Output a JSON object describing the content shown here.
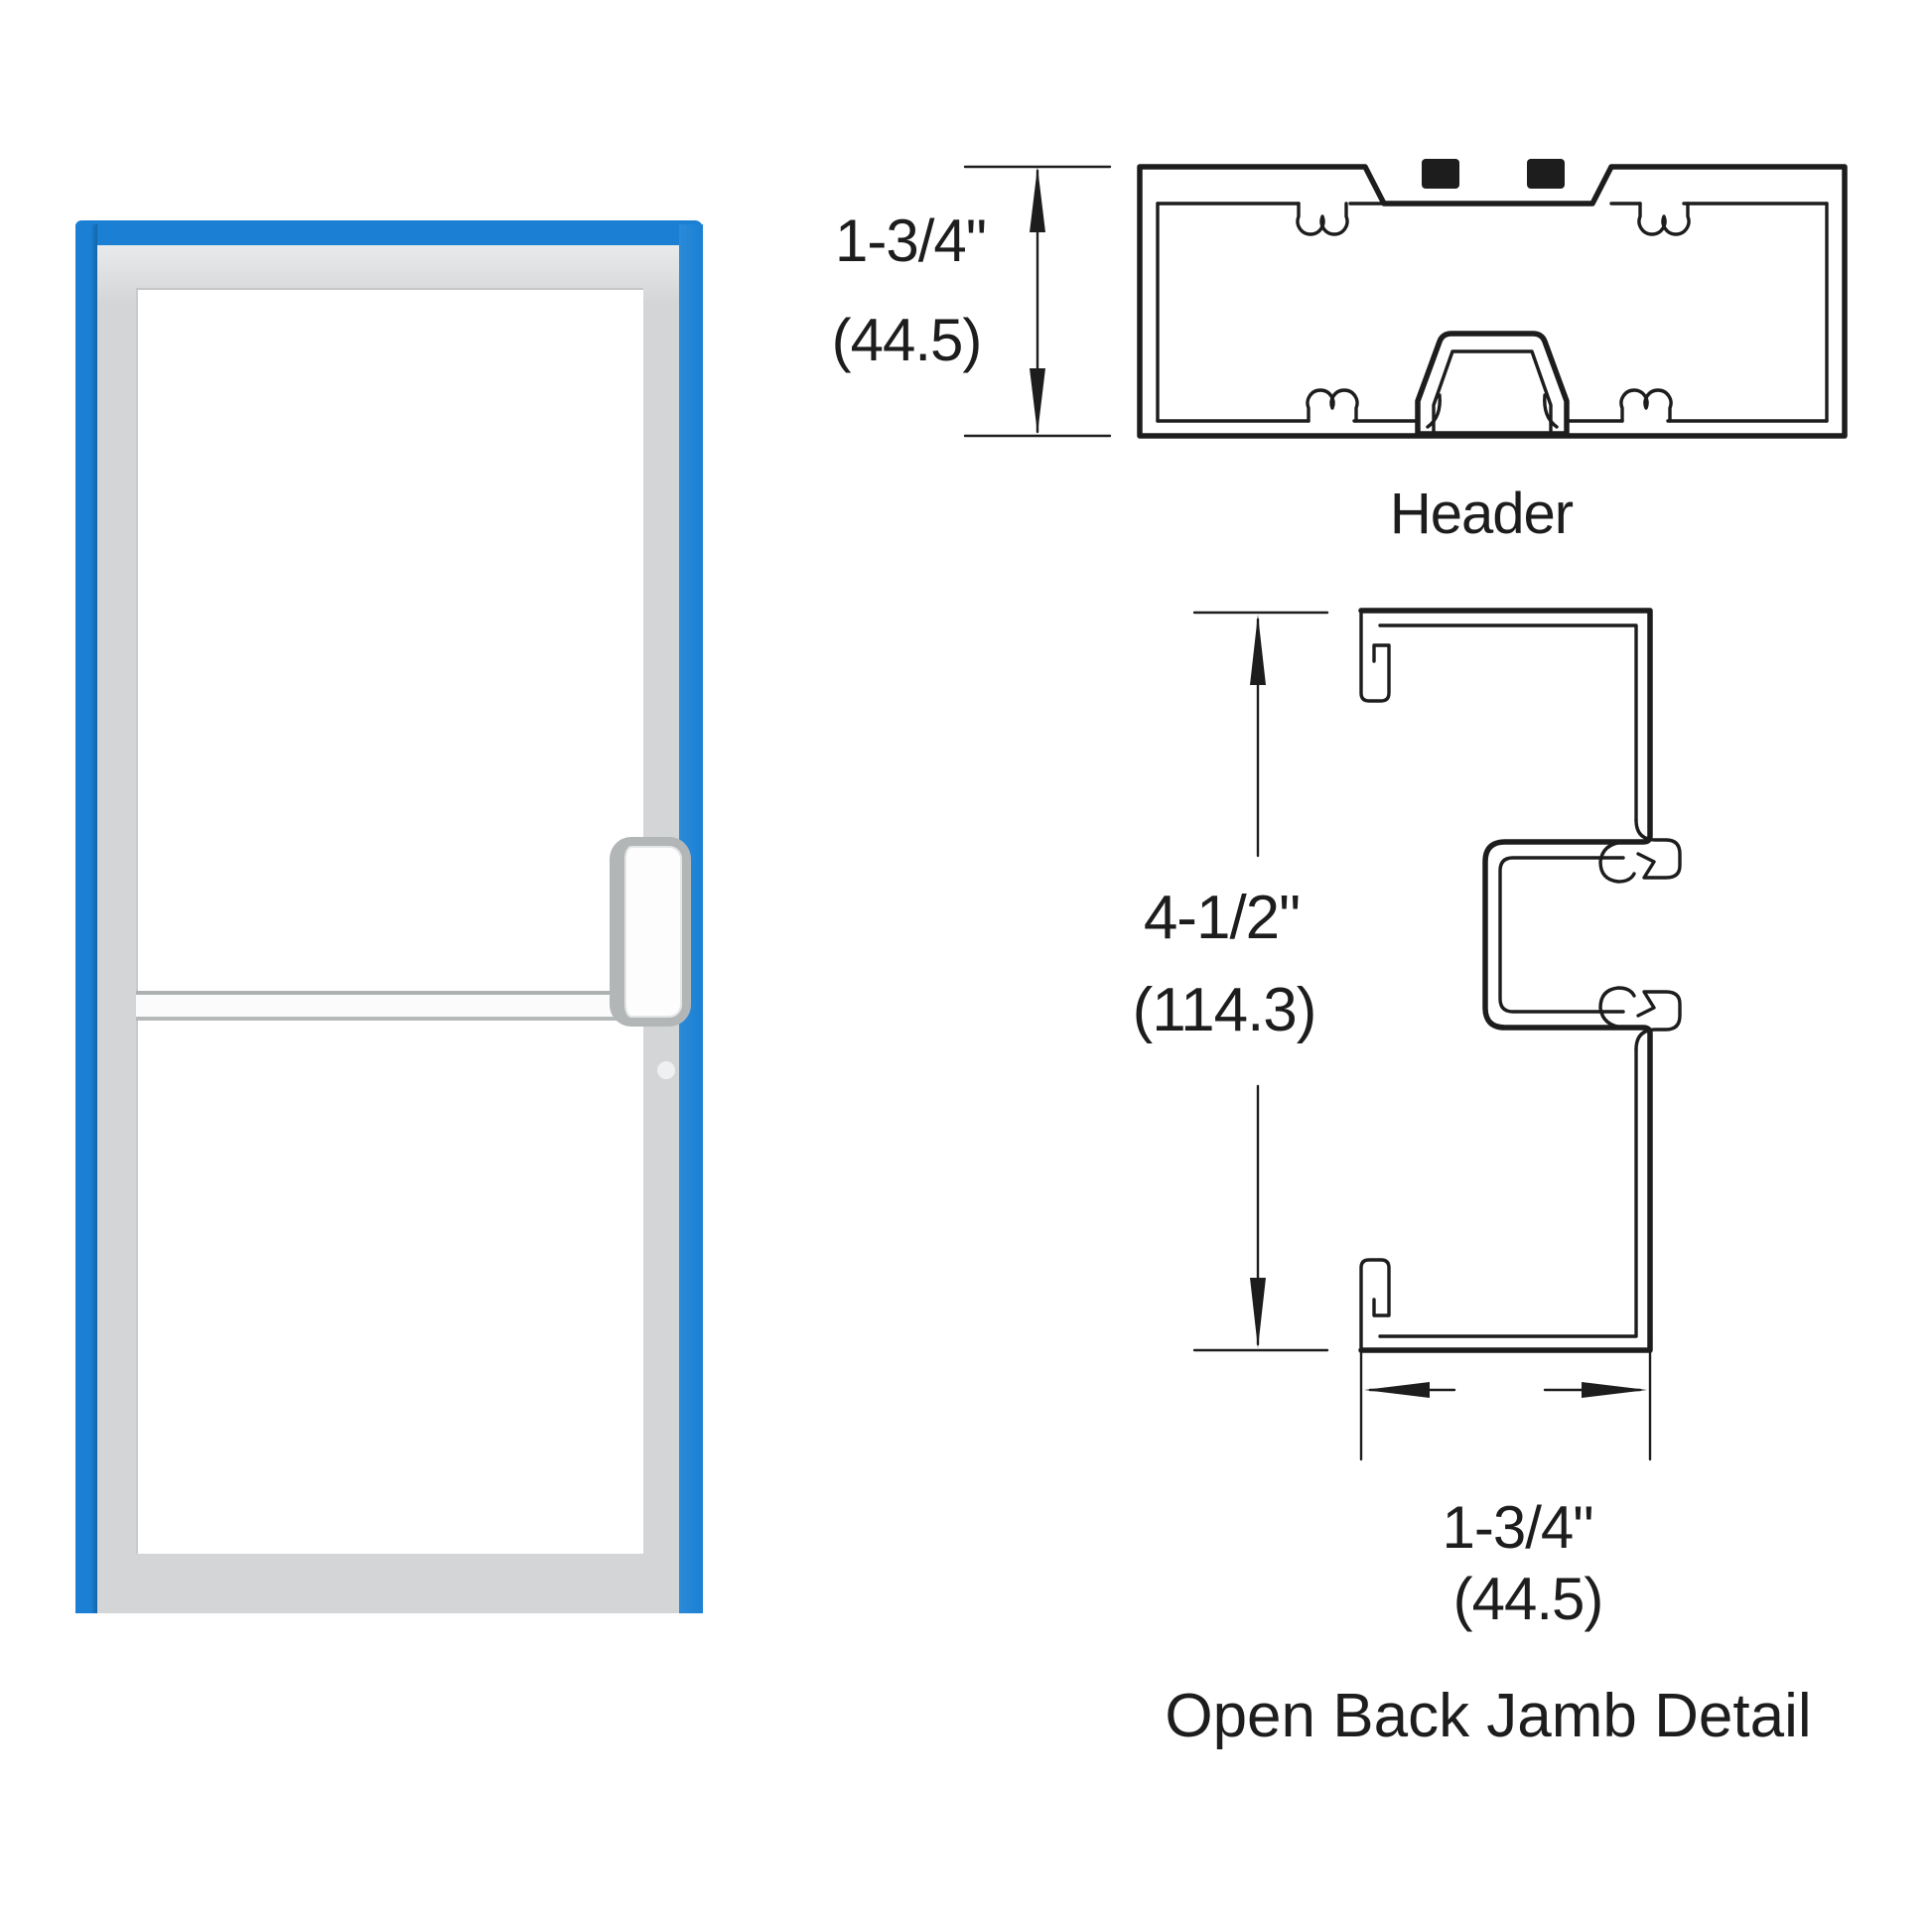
{
  "labels": {
    "header_title": "Header",
    "jamb_caption": "Open Back Jamb Detail"
  },
  "dimensions": {
    "header_height_in": "1-3/4\"",
    "header_height_mm": "(44.5)",
    "jamb_height_in": "4-1/2\"",
    "jamb_height_mm": "(114.3)",
    "jamb_width_in": "1-3/4\"",
    "jamb_width_mm": "(44.5)"
  },
  "colors": {
    "door_edge_blue": "#1b80d4",
    "door_frame_gray": "#d3d5d6",
    "line_ink": "#1d1d1d"
  }
}
